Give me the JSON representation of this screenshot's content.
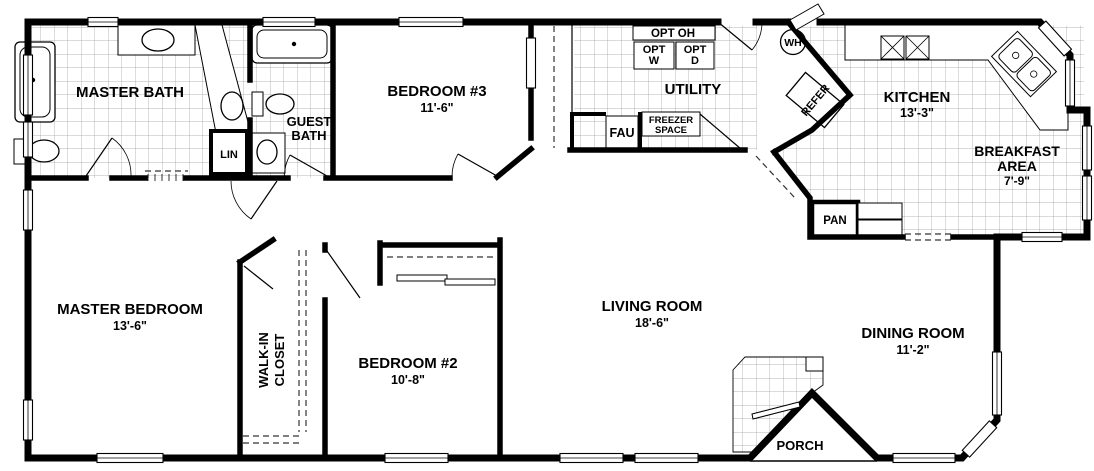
{
  "plan_title": "floor-plan",
  "colors": {
    "wall": "#000000",
    "tile_line": "#9b9b9b",
    "floor": "#ffffff"
  },
  "rooms": {
    "master_bath": {
      "name": "MASTER BATH"
    },
    "guest_bath": {
      "name_line1": "GUEST",
      "name_line2": "BATH"
    },
    "lin": {
      "name": "LIN"
    },
    "bedroom_3": {
      "name": "BEDROOM #3",
      "dim": "11'-6\""
    },
    "utility": {
      "name": "UTILITY"
    },
    "opt_oh": {
      "name": "OPT OH"
    },
    "opt_w": {
      "name_line1": "OPT",
      "name_line2": "W"
    },
    "opt_d": {
      "name_line1": "OPT",
      "name_line2": "D"
    },
    "fau": {
      "name": "FAU"
    },
    "freezer_space": {
      "name_line1": "FREEZER",
      "name_line2": "SPACE"
    },
    "water_heater": {
      "name": "WH"
    },
    "refrigerator": {
      "name": "REFER"
    },
    "kitchen": {
      "name": "KITCHEN",
      "dim": "13'-3\""
    },
    "breakfast_area": {
      "name_line1": "BREAKFAST",
      "name_line2": "AREA",
      "dim": "7'-9\""
    },
    "pantry": {
      "name": "PAN"
    },
    "master_bedroom": {
      "name": "MASTER BEDROOM",
      "dim": "13'-6\""
    },
    "walk_in_closet": {
      "name_line1": "WALK-IN",
      "name_line2": "CLOSET"
    },
    "bedroom_2": {
      "name": "BEDROOM #2",
      "dim": "10'-8\""
    },
    "living_room": {
      "name": "LIVING ROOM",
      "dim": "18'-6\""
    },
    "dining_room": {
      "name": "DINING ROOM",
      "dim": "11'-2\""
    },
    "porch": {
      "name": "PORCH"
    }
  }
}
